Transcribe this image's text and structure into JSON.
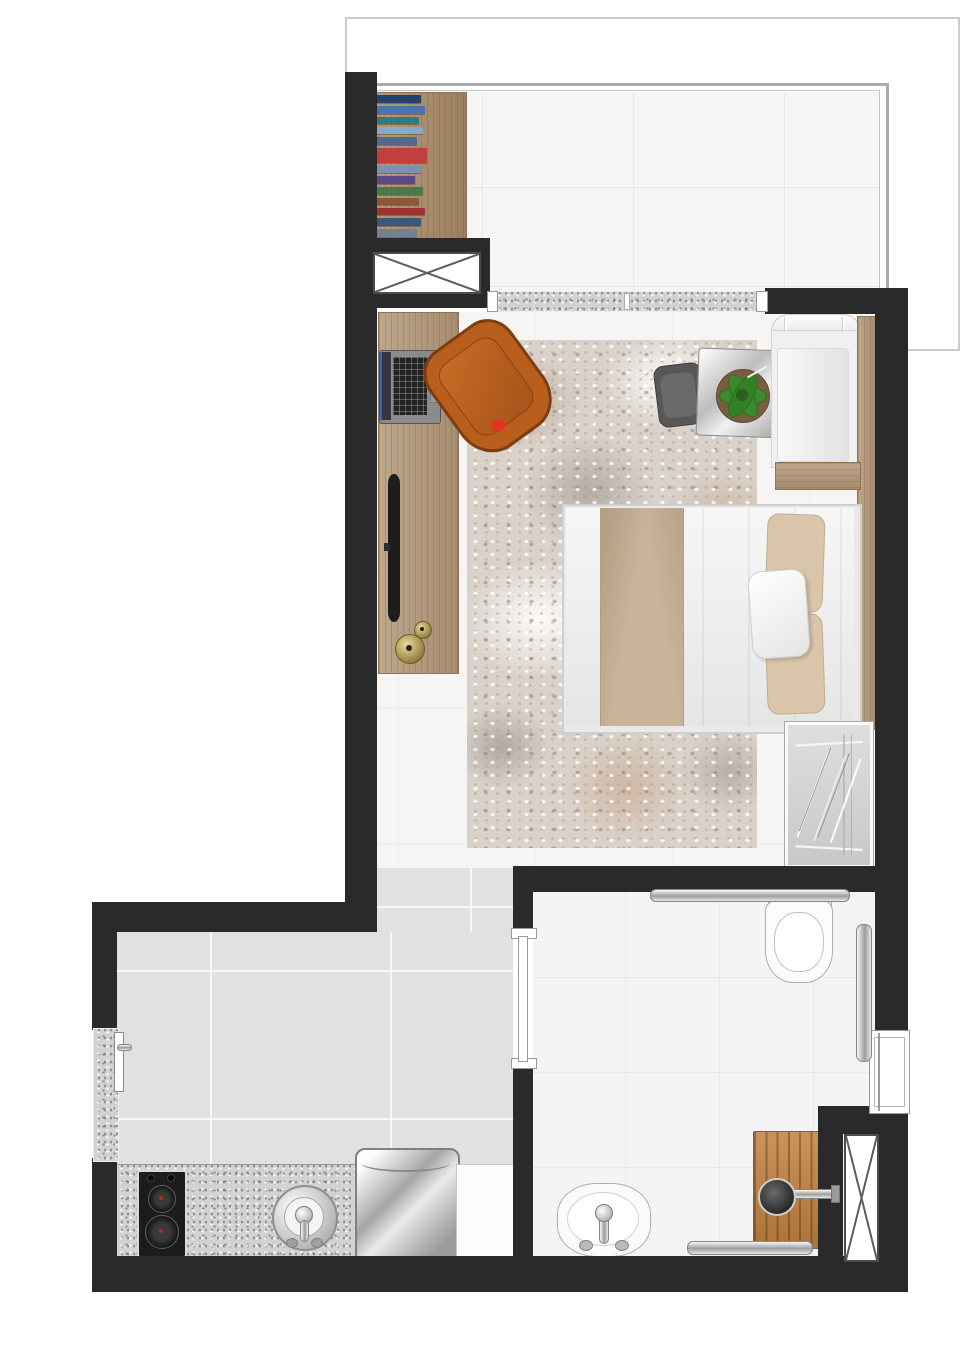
{
  "title": "studio-apartment-floor-plan",
  "palette": {
    "wall": "#2a2a2a",
    "line": "#cbcbcb",
    "floor_living": "#f6f5f3",
    "floor_kitchen": "#e1e1e1",
    "floor_bath": "#f4f4f4",
    "floor_balcony": "#f5f5f5",
    "granite": "#d2d2d2",
    "rug": "#d9d2ca",
    "wood": "#b49879",
    "wood_dark": "#a98a68",
    "deck": "#c08040",
    "sofa": "#f0f0f0",
    "duvet": "#ededed",
    "runner": "#c9b499",
    "pillow": "#d8c5aa",
    "armchair": "#b95f1e",
    "armchair_dark": "#7d3c12",
    "chair": "#585858",
    "plant": "#3c8a2e",
    "metal": "#c7c7c7",
    "red": "#e03520",
    "gold": "#caa84a"
  },
  "rooms": [
    {
      "name": "balcony"
    },
    {
      "name": "living-room"
    },
    {
      "name": "kitchen"
    },
    {
      "name": "bathroom"
    }
  ],
  "furniture": [
    "bookshelf",
    "ventilation-shaft",
    "sliding-door-sill",
    "desk",
    "laptop",
    "tv",
    "speakers",
    "armchair",
    "area-rug",
    "side-chair",
    "coffee-table",
    "potted-plant",
    "sofa",
    "double-bed",
    "pillows",
    "wardrobe",
    "toilet",
    "towel-rail",
    "shower-glass-panel",
    "window",
    "washbasin",
    "shower-deck",
    "shower-head",
    "kitchen-counter",
    "cooktop",
    "kitchen-sink",
    "washing-machine",
    "base-cabinet",
    "entrance-door"
  ],
  "books": [
    {
      "c": "#23406e",
      "h": 9,
      "w": 46
    },
    {
      "c": "#4a74b0",
      "h": 8,
      "w": 50
    },
    {
      "c": "#2e7d7d",
      "h": 8,
      "w": 44
    },
    {
      "c": "#89a9c9",
      "h": 7,
      "w": 48
    },
    {
      "c": "#55688c",
      "h": 8,
      "w": 42
    },
    {
      "c": "#c23f3f",
      "h": 16,
      "w": 52
    },
    {
      "c": "#7c90b4",
      "h": 8,
      "w": 46
    },
    {
      "c": "#5d4a85",
      "h": 8,
      "w": 40
    },
    {
      "c": "#4a7a4a",
      "h": 9,
      "w": 48
    },
    {
      "c": "#8a5a35",
      "h": 7,
      "w": 44
    },
    {
      "c": "#9c3232",
      "h": 8,
      "w": 50
    },
    {
      "c": "#3c567c",
      "h": 9,
      "w": 46
    },
    {
      "c": "#76808e",
      "h": 8,
      "w": 42
    }
  ]
}
